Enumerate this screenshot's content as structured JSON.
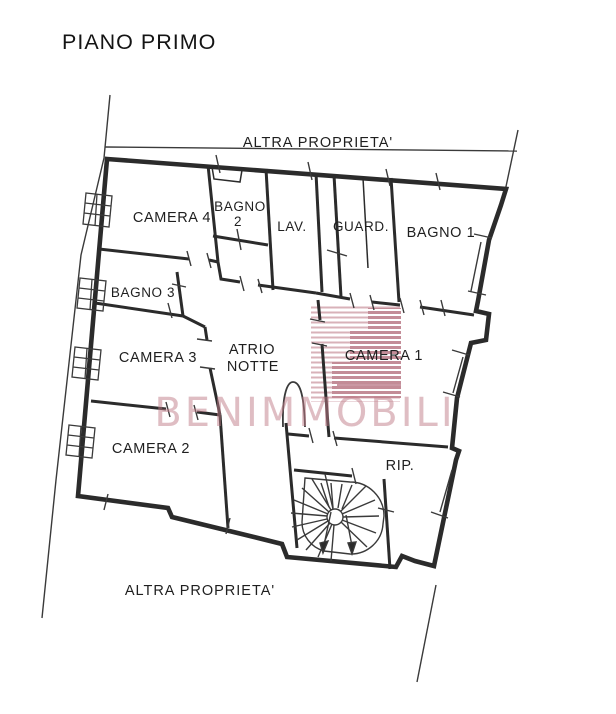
{
  "page": {
    "title": "PIANO PRIMO"
  },
  "boundaries": {
    "top_label": "ALTRA PROPRIETA'",
    "bottom_label": "ALTRA PROPRIETA'"
  },
  "rooms": {
    "camera4": {
      "label": "CAMERA 4"
    },
    "bagno2": {
      "line1": "BAGNO",
      "line2": "2"
    },
    "lav": {
      "label": "LAV."
    },
    "guard": {
      "label": "GUARD."
    },
    "bagno1": {
      "label": "BAGNO 1"
    },
    "bagno3": {
      "label": "BAGNO 3"
    },
    "camera3": {
      "label": "CAMERA 3"
    },
    "atrio": {
      "line1": "ATRIO",
      "line2": "NOTTE"
    },
    "camera1": {
      "label": "CAMERA 1"
    },
    "camera2": {
      "label": "CAMERA 2"
    },
    "rip": {
      "label": "RIP."
    }
  },
  "watermark": {
    "text": "BENIMMOBILI",
    "color": "#c07d89"
  },
  "colors": {
    "ink": "#2b2b2b",
    "boundary_line": "#3a3a3a",
    "watermark_light": "#cf9fa8",
    "watermark_dark": "#b5707e"
  }
}
